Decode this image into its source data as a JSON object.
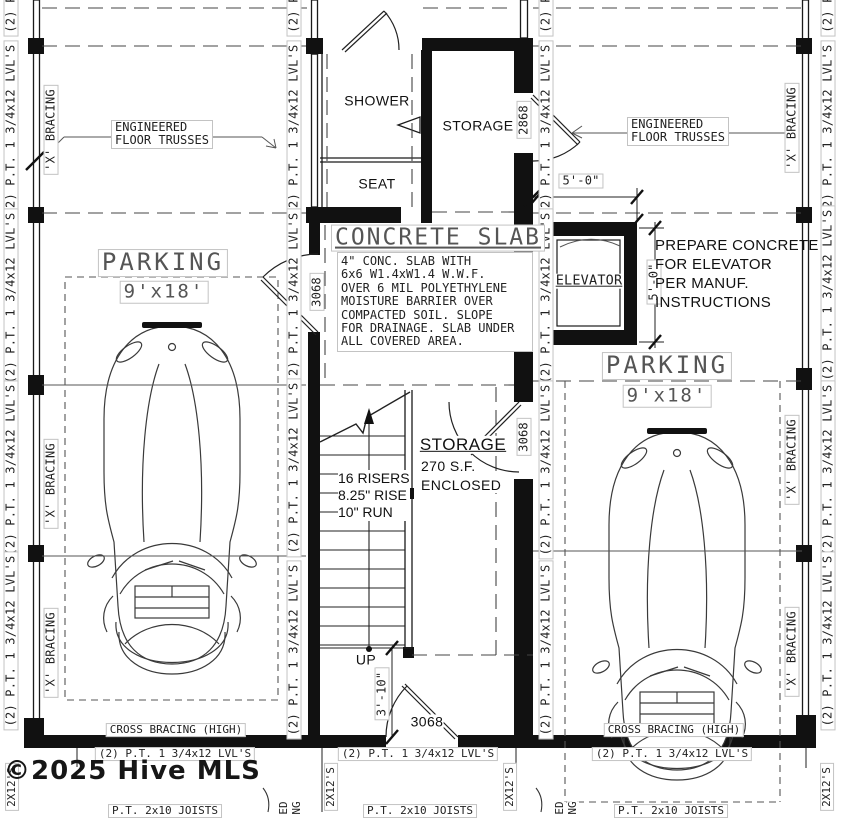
{
  "watermark": "©2025 Hive MLS",
  "rooms": {
    "shower": "SHOWER",
    "seat": "SEAT",
    "storage_top": "STORAGE",
    "elevator": "ELEVATOR",
    "storage_main": "STORAGE",
    "storage_area": "270 S.F.",
    "storage_enclosed": "ENCLOSED"
  },
  "parking": {
    "title": "PARKING",
    "size": "9'x18'"
  },
  "concrete": {
    "title": "CONCRETE SLAB",
    "note": [
      "4\" CONC. SLAB WITH",
      "6x6 W1.4xW1.4 W.W.F.",
      "OVER 6 MIL POLYETHYLENE",
      "MOISTURE BARRIER OVER",
      "COMPACTED SOIL. SLOPE",
      "FOR DRAINAGE. SLAB UNDER",
      "ALL COVERED AREA."
    ]
  },
  "elevator_note": [
    "PREPARE CONCRETE",
    "FOR ELEVATOR",
    "PER MANUF.",
    "INSTRUCTIONS"
  ],
  "stairs": {
    "risers": "16 RISERS",
    "rise": "8.25\" RISE",
    "run": "10\" RUN",
    "up": "UP"
  },
  "dims": {
    "elevator_width": "5'-0\"",
    "elevator_depth": "5'-0\"",
    "stair_landing": "3'-10\""
  },
  "doors": {
    "d2868": "2868",
    "d3068": "3068"
  },
  "framing": {
    "lvl": "(2) P.T. 1 3/4x12 LVL'S",
    "lvl_cut": "(2) P",
    "x_bracing": "'X' BRACING",
    "trusses_line1": "ENGINEERED",
    "trusses_line2": "FLOOR TRUSSES",
    "cross_bracing": "CROSS BRACING (HIGH)",
    "deck_joists": "2X12'S",
    "pt_joists": "P.T. 2x10 JOISTS",
    "cut_label_1": "ED",
    "cut_label_2": "NG"
  }
}
